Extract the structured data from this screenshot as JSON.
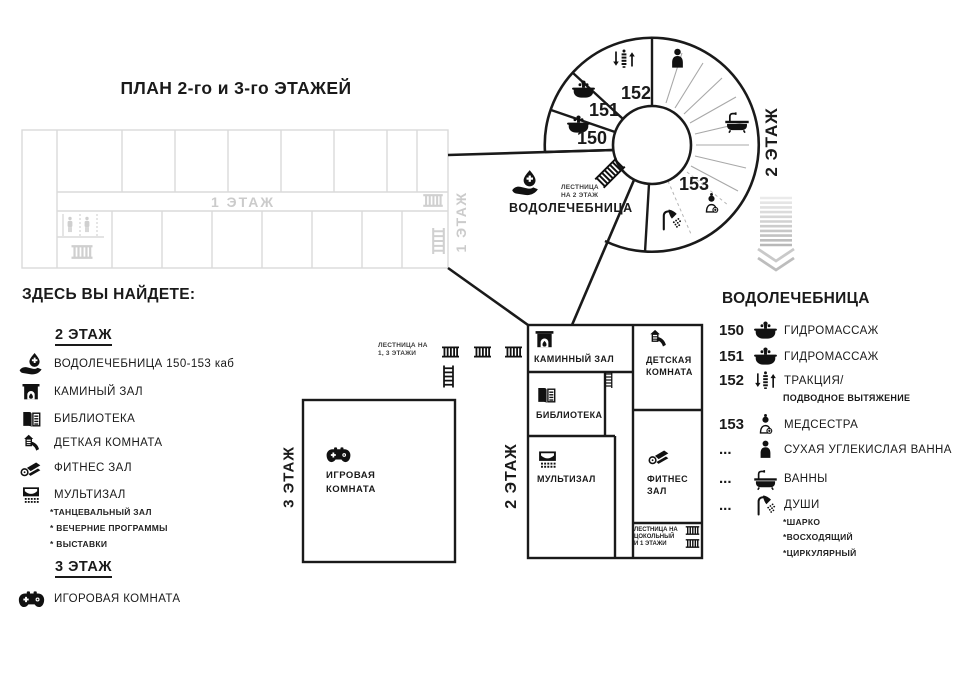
{
  "title": "ПЛАН 2-го и 3-го ЭТАЖЕЙ",
  "colors": {
    "ink": "#1a1a1a",
    "faded_lines": "#dadada",
    "faded_text": "#cbcbcb",
    "ray": "#a8a8a8",
    "chevron": "#c9c9c9"
  },
  "floor1": {
    "corridor_label": "1 ЭТАЖ",
    "side_label": "1 ЭТАЖ"
  },
  "rotunda": {
    "rooms": {
      "r150": "150",
      "r151": "151",
      "r152": "152",
      "r153": "153"
    },
    "side_label": "2 ЭТАЖ",
    "stairs_note": [
      "ЛЕСТНИЦА",
      "НА 2 ЭТАЖ"
    ],
    "label": "ВОДОЛЕЧЕБНИЦА",
    "icons": [
      "hydromassage-tub-icon",
      "hydromassage-tub-icon",
      "traction-icon",
      "person-icon",
      "bath-icon",
      "nurse-icon",
      "shower-icon",
      "stairs-hatch-icon",
      "water-hand-icon"
    ]
  },
  "stairs_mid": {
    "note": [
      "ЛЕСТНИЦА НА",
      "1, 3 ЭТАЖИ"
    ]
  },
  "floor2": {
    "side_label": "2 ЭТАЖ",
    "rooms": {
      "fireplace": "КАМИННЫЙ ЗАЛ",
      "kids": [
        "ДЕТСКАЯ",
        "КОМНАТА"
      ],
      "library": "БИБЛИОТЕКА",
      "multihall": "МУЛЬТИЗАЛ",
      "fitness": [
        "ФИТНЕС",
        "ЗАЛ"
      ]
    },
    "stairs_note": [
      "ЛЕСТНИЦА НА",
      "ЦОКОЛЬНЫЙ",
      "И 1 ЭТАЖИ"
    ]
  },
  "floor3": {
    "side_label": "3 ЭТАЖ",
    "room": [
      "ИГРОВАЯ",
      "КОМНАТА"
    ]
  },
  "legend_left": {
    "heading": "ЗДЕСЬ ВЫ НАЙДЕТЕ:",
    "floor2_heading": "2 ЭТАЖ",
    "items": [
      {
        "icon": "water-hand-icon",
        "label": "ВОДОЛЕЧЕБНИЦА 150-153 каб"
      },
      {
        "icon": "fireplace-icon",
        "label": "КАМИНЫЙ ЗАЛ"
      },
      {
        "icon": "book-icon",
        "label": "БИБЛИОТЕКА"
      },
      {
        "icon": "slide-icon",
        "label": "ДЕТКАЯ КОМНАТА"
      },
      {
        "icon": "fitness-mat-icon",
        "label": "ФИТНЕС ЗАЛ"
      },
      {
        "icon": "screen-icon",
        "label": "МУЛЬТИЗАЛ"
      }
    ],
    "multihall_notes": [
      "*ТАНЦЕВАЛЬНЫЙ ЗАЛ",
      "* ВЕЧЕРНИЕ ПРОГРАММЫ",
      "* ВЫСТАВКИ"
    ],
    "floor3_heading": "3 ЭТАЖ",
    "floor3_item": {
      "icon": "gamepad-icon",
      "label": "ИГОРОВАЯ КОМНАТА"
    }
  },
  "legend_right": {
    "heading": "ВОДОЛЕЧЕБНИЦА",
    "rows": [
      {
        "num": "150",
        "icon": "hydromassage-tub-icon",
        "label": "ГИДРОМАССАЖ"
      },
      {
        "num": "151",
        "icon": "hydromassage-tub-icon",
        "label": "ГИДРОМАССАЖ"
      },
      {
        "num": "152",
        "icon": "traction-icon",
        "label": "ТРАКЦИЯ/"
      },
      {
        "num": "153",
        "icon": "nurse-icon",
        "label": "МЕДСЕСТРА"
      },
      {
        "num": "...",
        "icon": "person-icon",
        "label": "СУХАЯ УГЛЕКИСЛАЯ ВАННА"
      },
      {
        "num": "...",
        "icon": "bath-icon",
        "label": "ВАННЫ"
      },
      {
        "num": "...",
        "icon": "shower-icon",
        "label": "ДУШИ"
      }
    ],
    "traction_sub": "ПОДВОДНОЕ ВЫТЯЖЕНИЕ",
    "shower_notes": [
      "*ШАРКО",
      "*ВОСХОДЯЩИЙ",
      "*ЦИРКУЛЯРНЫЙ"
    ]
  }
}
